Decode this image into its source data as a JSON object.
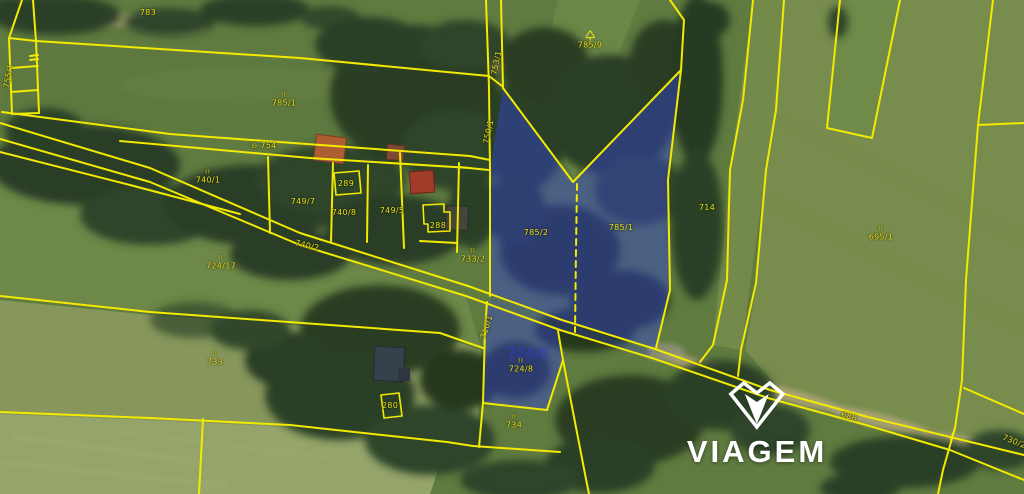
{
  "watermark": {
    "brand": "VIAGEM"
  },
  "map": {
    "type": "cadastral-aerial-map",
    "boundary_color": "#f2ea00",
    "label_color": "#ece11c",
    "highlight_color": "#3442cc",
    "highlighted_parcels": [
      "785/2",
      "785/1",
      "724/8"
    ],
    "labels": [
      {
        "text": "783",
        "x": 148,
        "y": 13
      },
      {
        "text": "785/9",
        "x": 590,
        "y": 40,
        "mark": "tree"
      },
      {
        "text": "785/1",
        "x": 284,
        "y": 100,
        "mark": "II"
      },
      {
        "text": "754",
        "x": 264,
        "y": 146,
        "prefix": "⊖"
      },
      {
        "text": "740/1",
        "x": 208,
        "y": 177,
        "mark": "II"
      },
      {
        "text": "289",
        "x": 346,
        "y": 184
      },
      {
        "text": "749/7",
        "x": 303,
        "y": 202
      },
      {
        "text": "740/8",
        "x": 344,
        "y": 213
      },
      {
        "text": "749/5",
        "x": 392,
        "y": 211
      },
      {
        "text": "288",
        "x": 438,
        "y": 226
      },
      {
        "text": "740/2",
        "x": 307,
        "y": 246,
        "rot": 13
      },
      {
        "text": "724/17",
        "x": 221,
        "y": 263,
        "mark": "II"
      },
      {
        "text": "733/2",
        "x": 473,
        "y": 256,
        "mark": "II"
      },
      {
        "text": "785/2",
        "x": 536,
        "y": 233
      },
      {
        "text": "785/1",
        "x": 621,
        "y": 228
      },
      {
        "text": "714",
        "x": 707,
        "y": 208
      },
      {
        "text": "695/1",
        "x": 881,
        "y": 234,
        "mark": "II"
      },
      {
        "text": "753/1",
        "x": 497,
        "y": 63,
        "rot": -78
      },
      {
        "text": "750/1",
        "x": 489,
        "y": 132,
        "rot": -78
      },
      {
        "text": "755/1",
        "x": 9,
        "y": 76,
        "rot": -80
      },
      {
        "text": "710/1",
        "x": 487,
        "y": 327,
        "rot": -72
      },
      {
        "text": "724/8",
        "x": 528,
        "y": 354,
        "kind": "ghost"
      },
      {
        "text": "724/8",
        "x": 521,
        "y": 366,
        "mark": "II"
      },
      {
        "text": "734",
        "x": 514,
        "y": 422,
        "mark": "II"
      },
      {
        "text": "733",
        "x": 215,
        "y": 359,
        "mark": "II"
      },
      {
        "text": "280",
        "x": 390,
        "y": 406
      },
      {
        "text": "688",
        "x": 849,
        "y": 417,
        "rot": 16
      },
      {
        "text": "730/2",
        "x": 1014,
        "y": 442,
        "rot": 22
      }
    ]
  }
}
